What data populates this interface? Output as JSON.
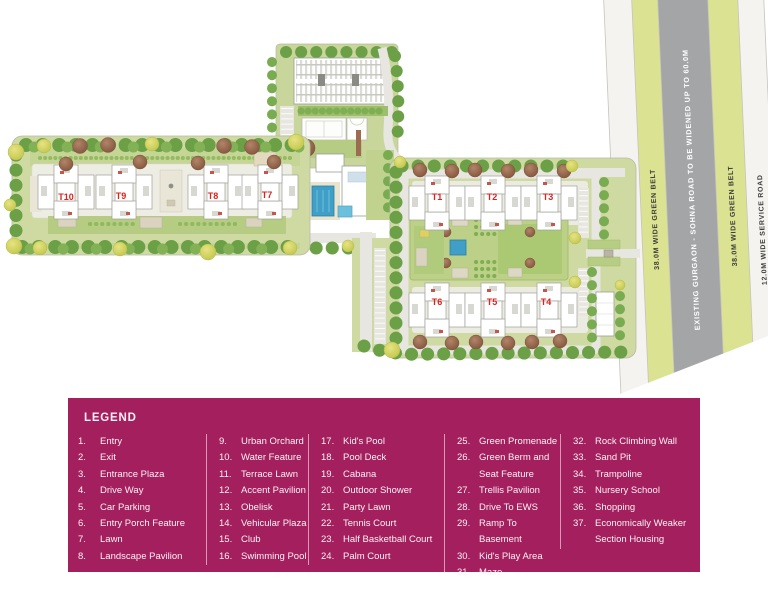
{
  "plan": {
    "tower_labels": {
      "t1": "T1",
      "t2": "T2",
      "t3": "T3",
      "t4": "T4",
      "t5": "T5",
      "t6": "T6",
      "t7": "T7",
      "t8": "T8",
      "t9": "T9",
      "t10": "T10"
    },
    "road_labels": {
      "service_left": "12.0M WIDE SERVICE ROAD",
      "green_left": "38.0M WIDE GREEN BELT",
      "main": "EXISTING GURGAON - SOHNA ROAD TO BE WIDENED UP TO 60.0M",
      "green_right": "38.0M WIDE GREEN BELT",
      "service_right": "12.0M WIDE SERVICE ROAD"
    }
  },
  "colors": {
    "legend_bg": "#a41f5e",
    "tower_label_red": "#d8231f",
    "green_belt": "#dbe291",
    "main_road_gray": "#a3a5a7",
    "lawn_green": "#cfdaa3",
    "pool_blue": "#3f9fc6"
  },
  "legend": {
    "title": "LEGEND",
    "columns": [
      {
        "items": [
          {
            "num": "1.",
            "label": "Entry"
          },
          {
            "num": "2.",
            "label": "Exit"
          },
          {
            "num": "3.",
            "label": "Entrance Plaza"
          },
          {
            "num": "4.",
            "label": "Drive Way"
          },
          {
            "num": "5.",
            "label": "Car Parking"
          },
          {
            "num": "6.",
            "label": "Entry Porch Feature"
          },
          {
            "num": "7.",
            "label": "Lawn"
          },
          {
            "num": "8.",
            "label": "Landscape Pavilion"
          }
        ]
      },
      {
        "items": [
          {
            "num": "9.",
            "label": "Urban Orchard"
          },
          {
            "num": "10.",
            "label": "Water Feature"
          },
          {
            "num": "11.",
            "label": "Terrace Lawn"
          },
          {
            "num": "12.",
            "label": "Accent Pavilion"
          },
          {
            "num": "13.",
            "label": "Obelisk"
          },
          {
            "num": "14.",
            "label": "Vehicular Plaza"
          },
          {
            "num": "15.",
            "label": "Club"
          },
          {
            "num": "16.",
            "label": "Swimming Pool"
          }
        ]
      },
      {
        "items": [
          {
            "num": "17.",
            "label": "Kid's Pool"
          },
          {
            "num": "18.",
            "label": "Pool Deck"
          },
          {
            "num": "19.",
            "label": "Cabana"
          },
          {
            "num": "20.",
            "label": "Outdoor Shower"
          },
          {
            "num": "21.",
            "label": "Party Lawn"
          },
          {
            "num": "22.",
            "label": "Tennis Court"
          },
          {
            "num": "23.",
            "label": "Half Basketball Court"
          },
          {
            "num": "24.",
            "label": "Palm Court"
          }
        ]
      },
      {
        "items": [
          {
            "num": "25.",
            "label": "Green Promenade"
          },
          {
            "num": "26.",
            "label": "Green Berm and Seat Feature"
          },
          {
            "num": "27.",
            "label": "Trellis Pavilion"
          },
          {
            "num": "28.",
            "label": "Drive To EWS"
          },
          {
            "num": "29.",
            "label": "Ramp To Basement"
          },
          {
            "num": "30.",
            "label": "Kid's Play Area"
          },
          {
            "num": "31.",
            "label": "Maze"
          }
        ]
      },
      {
        "items": [
          {
            "num": "32.",
            "label": "Rock Climbing Wall"
          },
          {
            "num": "33.",
            "label": "Sand Pit"
          },
          {
            "num": "34.",
            "label": "Trampoline"
          },
          {
            "num": "35.",
            "label": "Nursery School"
          },
          {
            "num": "36.",
            "label": "Shopping"
          },
          {
            "num": "37.",
            "label": "Economically Weaker Section Housing"
          }
        ]
      }
    ]
  }
}
